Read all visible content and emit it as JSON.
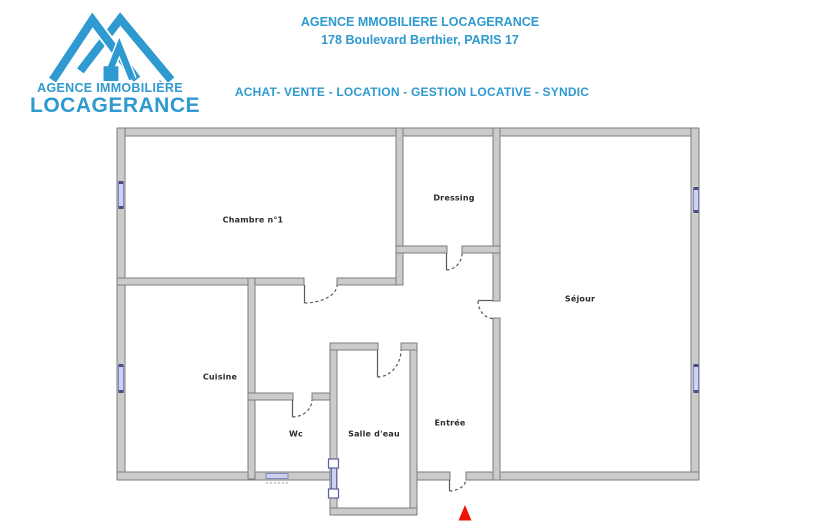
{
  "header": {
    "logo": {
      "icon": "double-roof-house-icon",
      "line1": "AGENCE IMMOBILIÈRE",
      "line2": "LOCAGERANCE"
    },
    "title": "AGENCE MMOBILIERE LOCAGERANCE",
    "address": "178 Boulevard Berthier, PARIS 17",
    "services": "ACHAT- VENTE - LOCATION - GESTION LOCATIVE - SYNDIC"
  },
  "floor_plan": {
    "rooms": [
      {
        "name": "Chambre n°1"
      },
      {
        "name": "Dressing"
      },
      {
        "name": "Séjour"
      },
      {
        "name": "Cuisine"
      },
      {
        "name": "Wc"
      },
      {
        "name": "Salle d'eau"
      },
      {
        "name": "Entrée"
      }
    ],
    "entrance_marker": "red-triangle"
  },
  "colors": {
    "brand_blue": "#2E9AD0",
    "wall_fill": "#CBCBCB",
    "wall_edge": "#7E7E7E",
    "window_glass": "#CDD2F2",
    "window_frame": "#5A5F9E",
    "marker_red": "#ED1509",
    "label_text": "#2B2B2B"
  }
}
